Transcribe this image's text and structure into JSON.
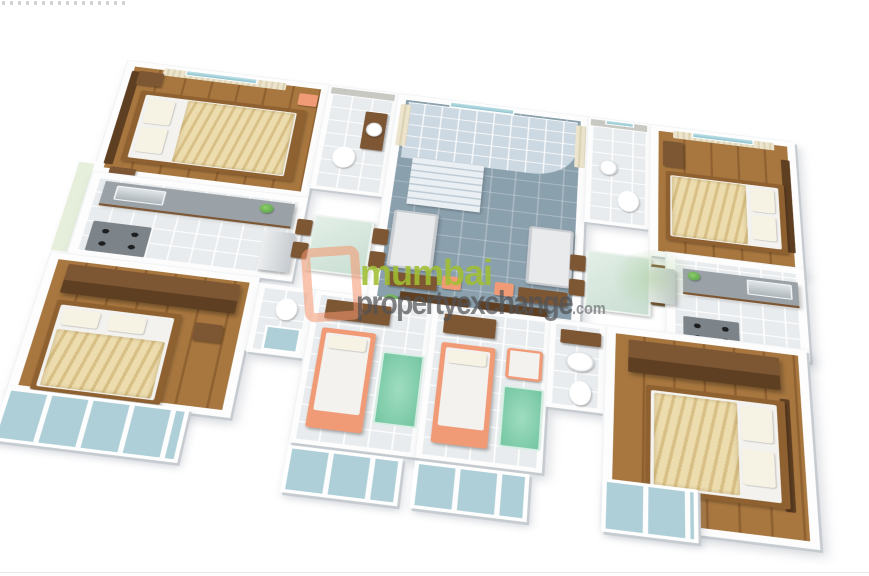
{
  "watermark": {
    "brand_line1": "mumbai",
    "brand_line2": "propertyexchange",
    "brand_suffix": ".com",
    "logo_shape": "salmon-rounded-square-outline",
    "tree_mark": "faint-green-tree"
  },
  "scene": {
    "type": "3d-isometric-floor-plan",
    "rooms": [
      {
        "id": "bedroom-top-left",
        "floor": "wood",
        "furniture": [
          "double-bed-cream",
          "windows-curtains",
          "side-tables"
        ]
      },
      {
        "id": "bathroom-top-left",
        "floor": "tile",
        "furniture": [
          "toilet",
          "basin-counter"
        ]
      },
      {
        "id": "living-hall-center",
        "floor": "slate-tile",
        "furniture": [
          "staircase",
          "two-sofas",
          "desks",
          "entrance-double-doors"
        ]
      },
      {
        "id": "bathroom-top-right",
        "floor": "tile",
        "furniture": [
          "toilet",
          "window"
        ]
      },
      {
        "id": "bedroom-top-right",
        "floor": "wood",
        "furniture": [
          "double-bed-gold",
          "windows-curtains",
          "dresser"
        ]
      },
      {
        "id": "kitchen-left",
        "floor": "tile",
        "furniture": [
          "sink-counter",
          "hob",
          "fridge"
        ]
      },
      {
        "id": "dining-left",
        "floor": "tile",
        "furniture": [
          "glass-table",
          "chairs"
        ]
      },
      {
        "id": "dining-right",
        "floor": "tile",
        "furniture": [
          "glass-table",
          "chairs"
        ]
      },
      {
        "id": "kitchen-right",
        "floor": "tile",
        "furniture": [
          "sink-counter",
          "hob",
          "fridge"
        ]
      },
      {
        "id": "bedroom-bottom-left",
        "floor": "wood",
        "furniture": [
          "double-bed-cream",
          "wardrobe",
          "glass-balcony"
        ]
      },
      {
        "id": "bathroom-bottom-center",
        "floor": "tile",
        "furniture": [
          "toilet",
          "shower"
        ]
      },
      {
        "id": "kids-room-a",
        "floor": "tile",
        "furniture": [
          "single-bed-orange",
          "green-rug",
          "desk",
          "glass-balcony"
        ]
      },
      {
        "id": "kids-room-b",
        "floor": "tile",
        "furniture": [
          "single-bed-orange",
          "armchair",
          "green-rug",
          "glass-balcony"
        ]
      },
      {
        "id": "bathroom-bottom-right",
        "floor": "tile",
        "furniture": [
          "pedestal-basin",
          "toilet"
        ]
      },
      {
        "id": "bedroom-bottom-right",
        "floor": "wood",
        "furniture": [
          "double-bed-cream",
          "wardrobe",
          "glass-balcony"
        ]
      }
    ]
  },
  "palette": {
    "wood": "#a8773f",
    "wood-dark": "#8f6130",
    "brown": "#7d5633",
    "brown-dark": "#5f3f22",
    "tile": "#e9eceE",
    "slate": "#8ba0ad",
    "stair": "#ccd9e2",
    "glass": "#aecfd8",
    "rug": "#74c6a2",
    "salmon": "#f09a76",
    "duvet": "#ecdcae",
    "duvet-dark": "#d8bf85",
    "counter": "#9aa1a7",
    "curtain": "#ece4cd",
    "wall-shade": "#c6cbd0",
    "brand-green": "#9fbe31",
    "brand-gray": "#58595b"
  }
}
